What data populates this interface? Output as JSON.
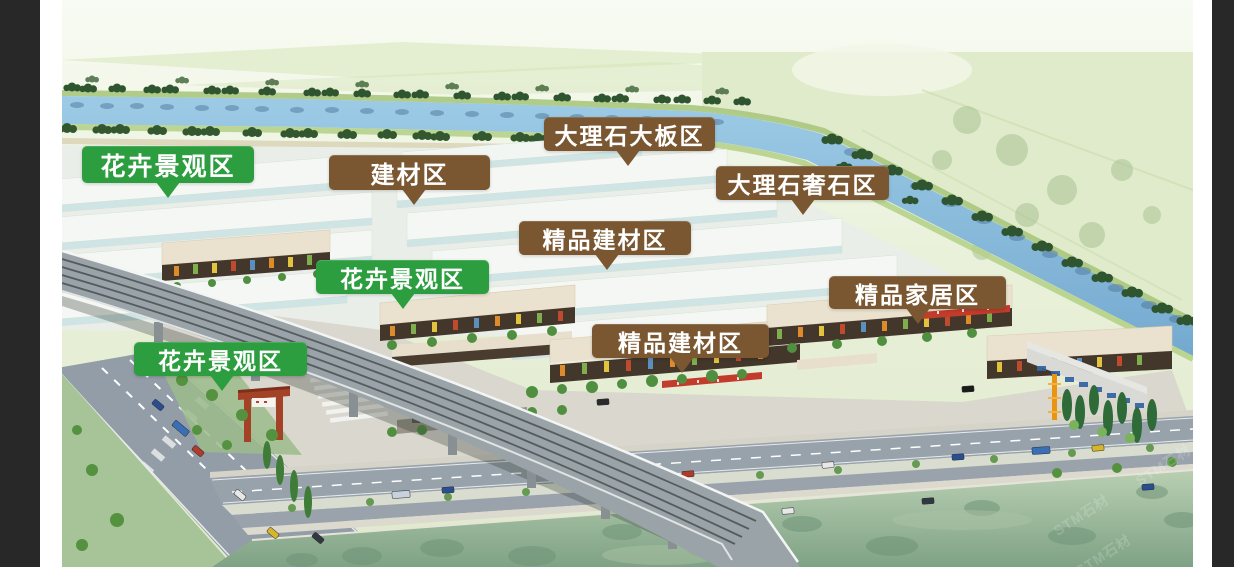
{
  "window": {
    "background_color": "#282828",
    "matte_color": "#ffffff"
  },
  "image": {
    "type": "aerial-architectural-rendering",
    "subject": "building materials market campus masterplan",
    "watermark_text": "STM石材"
  },
  "zone_labels": [
    {
      "text": "花卉景观区",
      "style": "green"
    },
    {
      "text": "建材区",
      "style": "brown"
    },
    {
      "text": "大理石大板区",
      "style": "brown"
    },
    {
      "text": "大理石奢石区",
      "style": "brown"
    },
    {
      "text": "精品建材区",
      "style": "brown"
    },
    {
      "text": "花卉景观区",
      "style": "green"
    },
    {
      "text": "精品家居区",
      "style": "brown"
    },
    {
      "text": "精品建材区",
      "style": "brown"
    },
    {
      "text": "花卉景观区",
      "style": "green"
    }
  ],
  "palette": {
    "green_label": "#2d9e40",
    "brown_label": "#7a5731",
    "label_text": "#ffffff",
    "river": "#86bedf",
    "fields": "#dfeacb",
    "warehouse_roof": "#f4f7f3",
    "warehouse_side": "#cfe4e4",
    "retail_roof": "#e9e1cd",
    "retail_facade": "#43372b",
    "road": "#98a2ab",
    "lawn": "#a6c497",
    "waterfront_green": "#8fae92",
    "tree_dark": "#2f5530",
    "tree_mid": "#55923f",
    "viaduct": "#9aa3a8",
    "gate_red": "#a34227",
    "tower_orange": "#e8950f"
  },
  "scene_features": [
    "canal-river",
    "riverbank-tree-rows",
    "farm-fields",
    "warehouse-rows",
    "retail-street-blocks",
    "elevated-rail-viaduct",
    "road-intersection",
    "entrance-gate",
    "parking-shelters",
    "waterfront-green-band"
  ]
}
